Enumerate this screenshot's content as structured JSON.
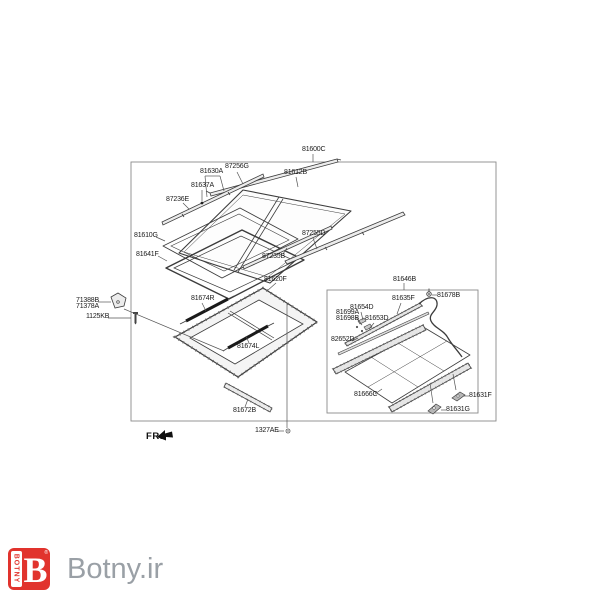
{
  "page": {
    "background": "#ffffff",
    "line_color": "#3c3c3c",
    "box_line_color": "#8a8a8a"
  },
  "diagram": {
    "type": "exploded-parts-diagram",
    "subject": "panorama sunroof assembly",
    "outer_box_label": "81600C",
    "inner_box_label": "81646B",
    "direction_label": "FR.",
    "labels": [
      {
        "name": "part-label-81600C",
        "text": "81600C",
        "x": 302,
        "y": 146
      },
      {
        "name": "part-label-87256G",
        "text": "87256G",
        "x": 225,
        "y": 163
      },
      {
        "name": "part-label-81630A",
        "text": "81630A",
        "x": 200,
        "y": 168
      },
      {
        "name": "part-label-81612B",
        "text": "81612B",
        "x": 284,
        "y": 169
      },
      {
        "name": "part-label-81637A",
        "text": "81637A",
        "x": 191,
        "y": 182
      },
      {
        "name": "part-label-87236E",
        "text": "87236E",
        "x": 166,
        "y": 196
      },
      {
        "name": "part-label-81610G",
        "text": "81610G",
        "x": 134,
        "y": 232
      },
      {
        "name": "part-label-87255D",
        "text": "87255D",
        "x": 302,
        "y": 230
      },
      {
        "name": "part-label-81641F",
        "text": "81641F",
        "x": 136,
        "y": 251
      },
      {
        "name": "part-label-87235B",
        "text": "87235B",
        "x": 262,
        "y": 253
      },
      {
        "name": "part-label-81620F",
        "text": "81620F",
        "x": 264,
        "y": 276
      },
      {
        "name": "part-label-81674R",
        "text": "81674R",
        "x": 191,
        "y": 295
      },
      {
        "name": "part-label-71388B",
        "text": "71388B",
        "x": 76,
        "y": 297
      },
      {
        "name": "part-label-71378A",
        "text": "71378A",
        "x": 76,
        "y": 303
      },
      {
        "name": "part-label-1125KB",
        "text": "1125KB",
        "x": 86,
        "y": 313
      },
      {
        "name": "part-label-81674L",
        "text": "81674L",
        "x": 237,
        "y": 343
      },
      {
        "name": "part-label-81672B",
        "text": "81672B",
        "x": 233,
        "y": 407
      },
      {
        "name": "part-label-1327AE",
        "text": "1327AE",
        "x": 255,
        "y": 427
      },
      {
        "name": "part-label-81646B",
        "text": "81646B",
        "x": 393,
        "y": 276
      },
      {
        "name": "part-label-81635F",
        "text": "81635F",
        "x": 392,
        "y": 295
      },
      {
        "name": "part-label-81678B",
        "text": "81678B",
        "x": 437,
        "y": 292
      },
      {
        "name": "part-label-81654D",
        "text": "81654D",
        "x": 350,
        "y": 304
      },
      {
        "name": "part-label-81699A",
        "text": "81699A",
        "x": 336,
        "y": 309
      },
      {
        "name": "part-label-81698B",
        "text": "81698B",
        "x": 336,
        "y": 315
      },
      {
        "name": "part-label-81653D",
        "text": "81653D",
        "x": 365,
        "y": 315
      },
      {
        "name": "part-label-82652D",
        "text": "82652D",
        "x": 331,
        "y": 336
      },
      {
        "name": "part-label-81666C",
        "text": "81666C",
        "x": 354,
        "y": 391
      },
      {
        "name": "part-label-81631F",
        "text": "81631F",
        "x": 469,
        "y": 392
      },
      {
        "name": "part-label-81631G",
        "text": "81631G",
        "x": 446,
        "y": 406
      },
      {
        "name": "direction-label-fr",
        "text": "FR.",
        "x": 146,
        "y": 433,
        "cls": "fr"
      }
    ]
  },
  "footer": {
    "brand_text": "Botny.ir",
    "brand_text_color": "#9aa0a6",
    "logo_letter": "B",
    "logo_vertical_text": "BOTNY",
    "logo_registered_mark": "®",
    "logo_color": "#e1332d"
  }
}
